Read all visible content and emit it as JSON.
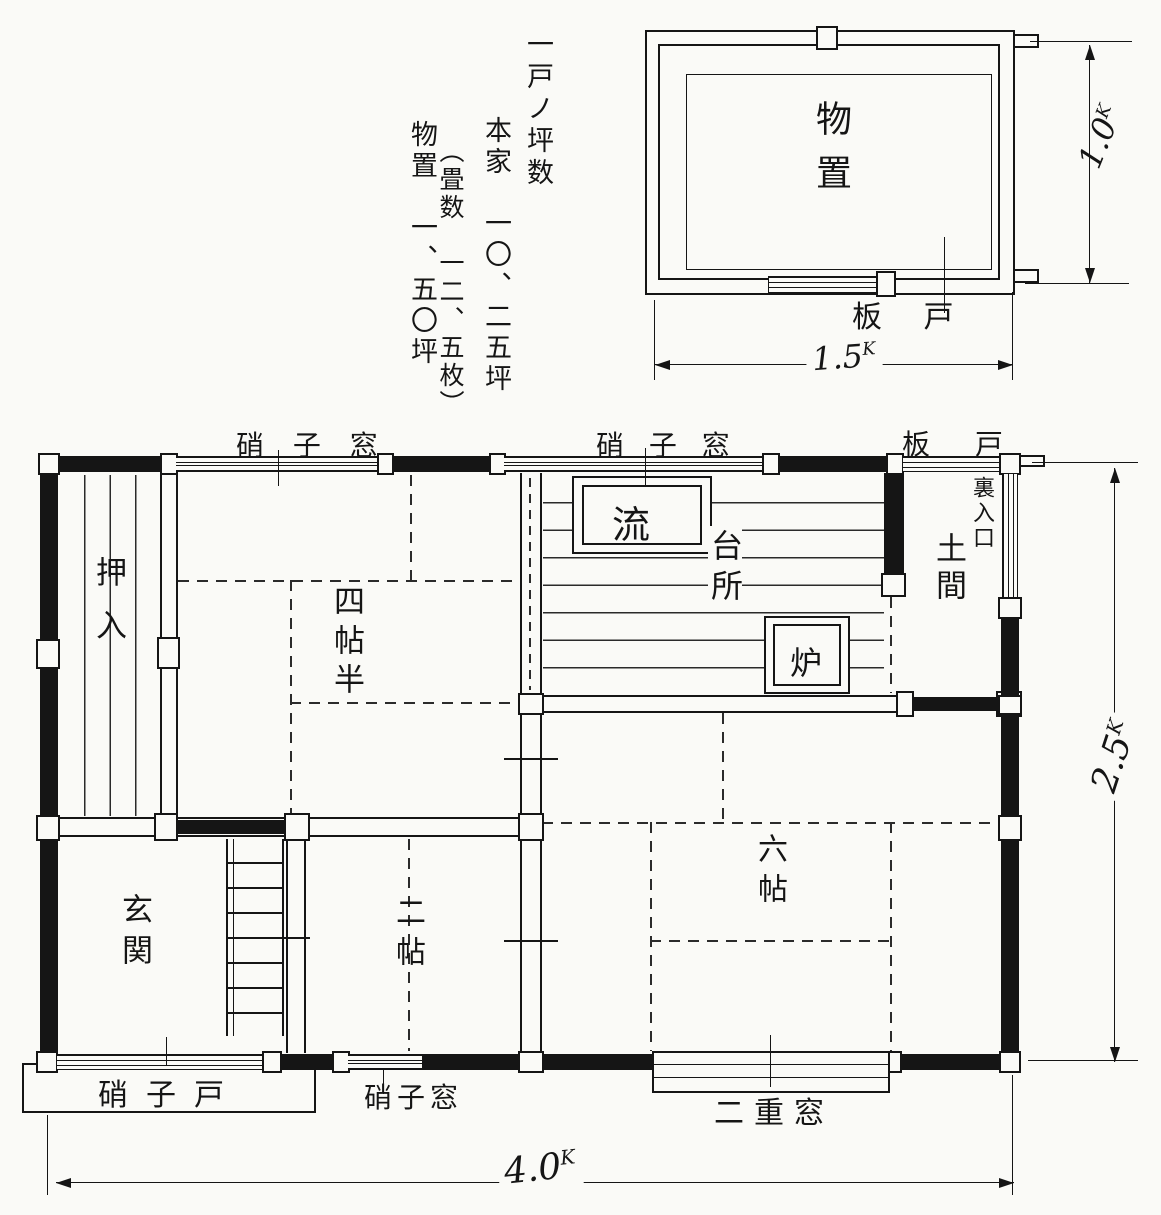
{
  "notes": {
    "col1": "一戸ノ坪数",
    "col2": "本家　一〇、二五坪",
    "col3": "（畳数　一二、五枚）",
    "col4": "物置　一、五〇坪"
  },
  "shed": {
    "room": "物置",
    "door": "板 戸",
    "width_value": "1.5",
    "height_value": "1.0",
    "unit": "K"
  },
  "main": {
    "window_top_left": "硝 子 窓",
    "window_top_mid": "硝 子 窓",
    "door_top_right": "板 戸",
    "back_entrance": "裏入口",
    "doma": "土間",
    "kitchen": "台所",
    "sink": "流",
    "hearth": "炉",
    "closet": "押入",
    "room45": "四帖半",
    "genkan": "玄関",
    "room2": "二帖",
    "room6": "六帖",
    "glass_door": "硝子戸",
    "window_bottom": "硝子窓",
    "double_window": "二重窓",
    "width_value": "4.0",
    "height_value": "2.5",
    "unit": "K"
  }
}
